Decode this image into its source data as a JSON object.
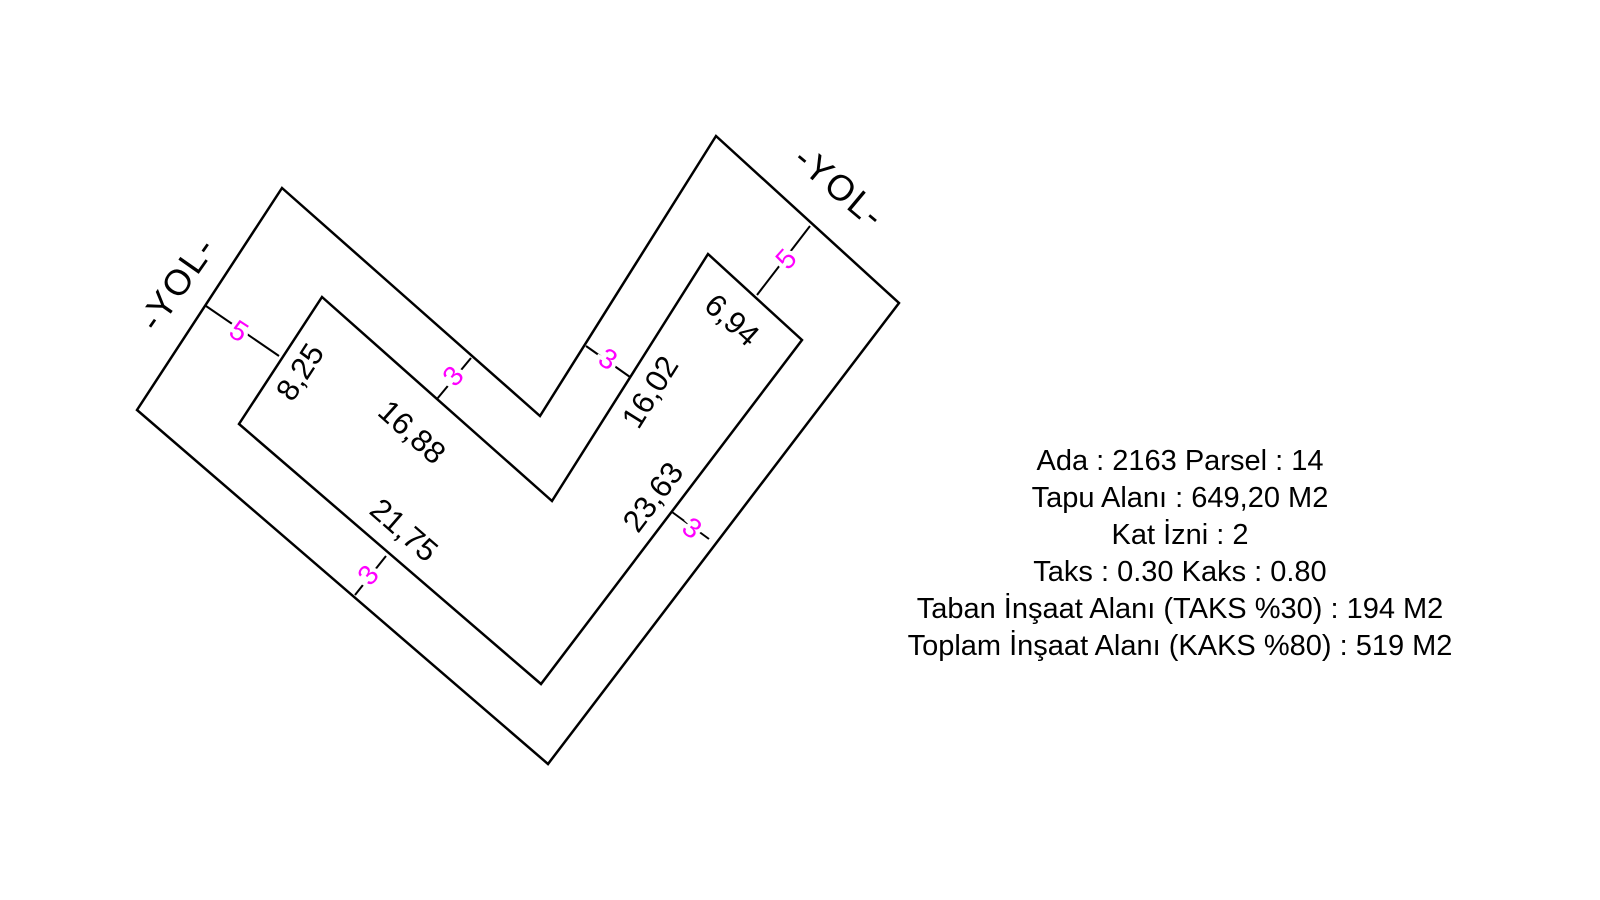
{
  "colors": {
    "line": "#000000",
    "dimension_text": "#000000",
    "setback_text": "#ff00ff",
    "background": "#ffffff"
  },
  "diagram": {
    "roads": [
      {
        "label": "-YOL-",
        "x": 177,
        "y": 283,
        "rot": -55
      },
      {
        "label": "-YOL-",
        "x": 840,
        "y": 187,
        "rot": 40
      }
    ],
    "parcel": {
      "outer_boundary": [
        [
          282,
          188
        ],
        [
          540,
          416
        ],
        [
          716,
          136
        ],
        [
          899,
          303
        ],
        [
          548,
          764
        ],
        [
          137,
          410
        ]
      ],
      "inner_boundary": [
        [
          322,
          297
        ],
        [
          552,
          501
        ],
        [
          708,
          254
        ],
        [
          802,
          340
        ],
        [
          541,
          684
        ],
        [
          239,
          424
        ]
      ]
    },
    "dimensions": [
      {
        "label": "8,25",
        "x": 300,
        "y": 372,
        "rot": -57
      },
      {
        "label": "16,88",
        "x": 412,
        "y": 432,
        "rot": 42
      },
      {
        "label": "16,02",
        "x": 650,
        "y": 392,
        "rot": -58
      },
      {
        "label": "6,94",
        "x": 732,
        "y": 320,
        "rot": 42
      },
      {
        "label": "21,75",
        "x": 404,
        "y": 530,
        "rot": 41
      },
      {
        "label": "23,63",
        "x": 653,
        "y": 497,
        "rot": -53
      }
    ],
    "setbacks": [
      {
        "label": "5",
        "x1": 206,
        "y1": 306,
        "x2": 279,
        "y2": 356,
        "lx": 239,
        "ly": 331,
        "rot": 33
      },
      {
        "label": "5",
        "x1": 810,
        "y1": 226,
        "x2": 757,
        "y2": 295,
        "lx": 786,
        "ly": 259,
        "rot": -48
      },
      {
        "label": "3",
        "x1": 471,
        "y1": 358,
        "x2": 437,
        "y2": 399,
        "lx": 453,
        "ly": 376,
        "rot": -48
      },
      {
        "label": "3",
        "x1": 586,
        "y1": 346,
        "x2": 630,
        "y2": 377,
        "lx": 608,
        "ly": 359,
        "rot": 32
      },
      {
        "label": "3",
        "x1": 386,
        "y1": 556,
        "x2": 355,
        "y2": 595,
        "lx": 368,
        "ly": 575,
        "rot": -49
      },
      {
        "label": "3",
        "x1": 672,
        "y1": 512,
        "x2": 709,
        "y2": 539,
        "lx": 692,
        "ly": 528,
        "rot": 37
      }
    ]
  },
  "info": {
    "lines": [
      "Ada : 2163 Parsel : 14",
      "Tapu Alanı : 649,20 M2",
      "Kat İzni : 2",
      "Taks : 0.30 Kaks : 0.80",
      "Taban İnşaat Alanı (TAKS %30) : 194 M2",
      "Toplam İnşaat Alanı (KAKS %80) : 519 M2"
    ]
  }
}
